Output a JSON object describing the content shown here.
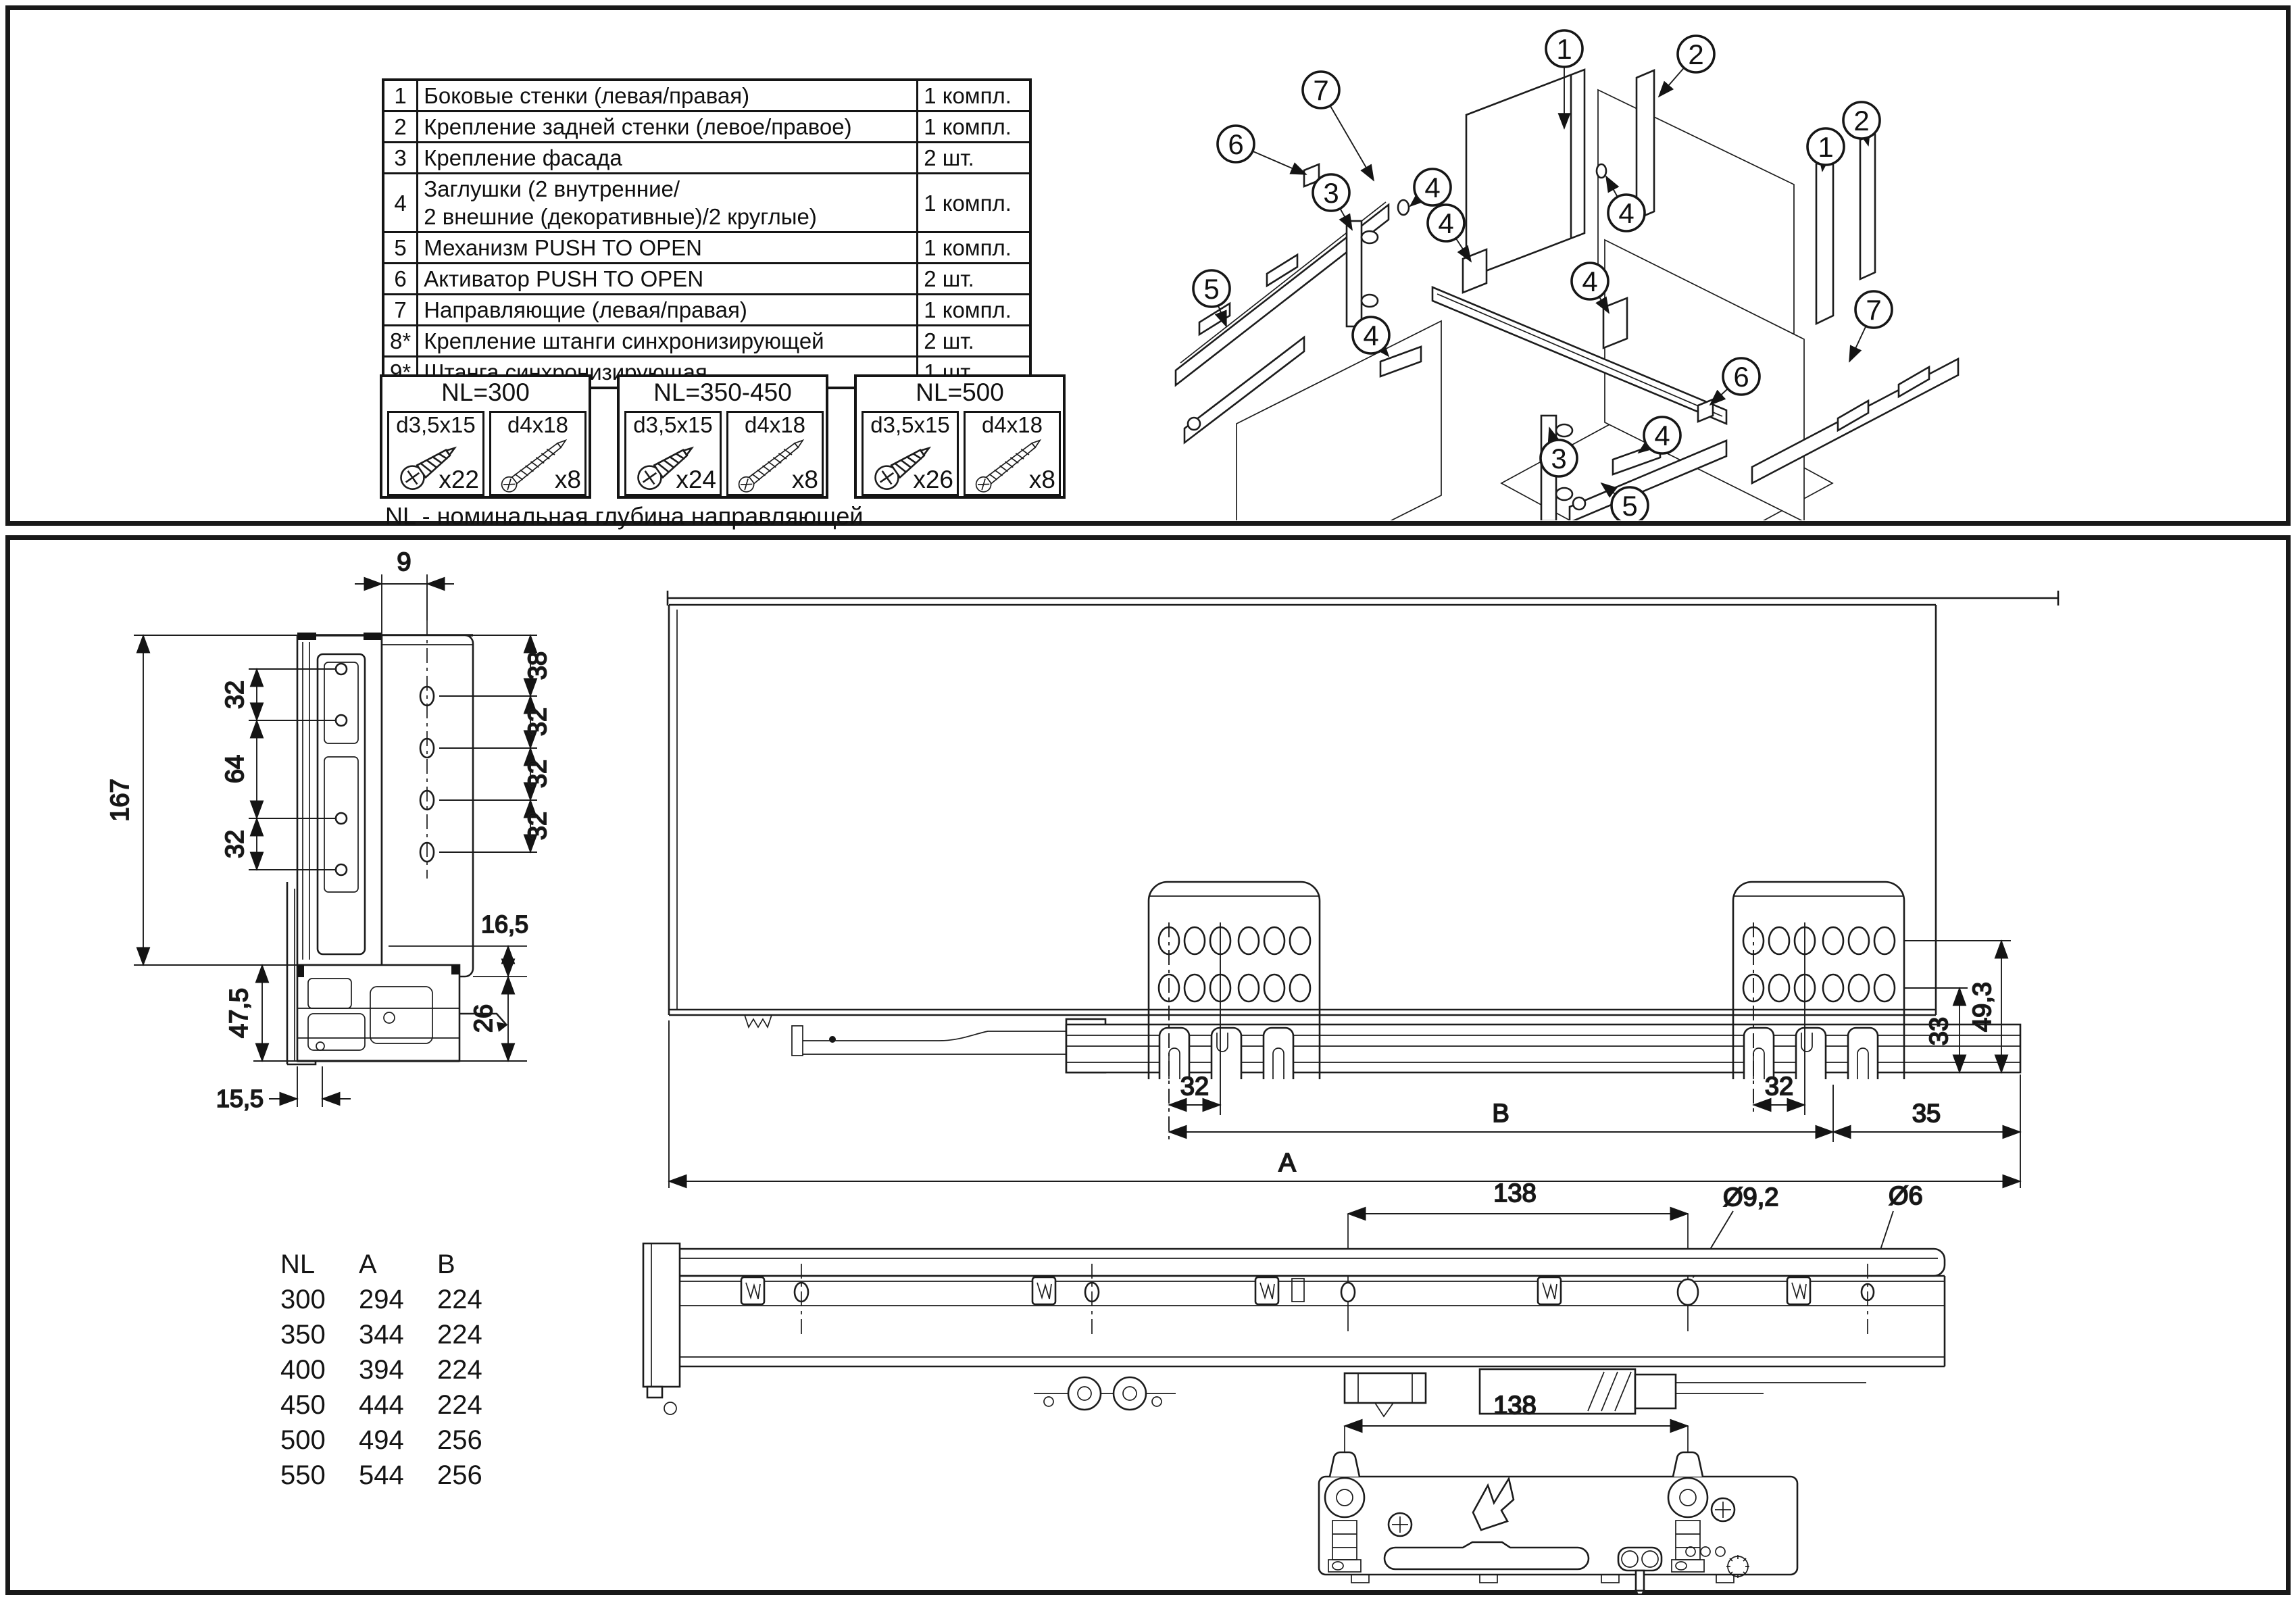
{
  "header": {
    "bullets": [
      "- полное выдвижение",
      "- максимальная нагрузка 40 кг"
    ]
  },
  "parts_table": {
    "rows": [
      {
        "num": "1",
        "name": "Боковые стенки (левая/правая)",
        "qty": "1 компл."
      },
      {
        "num": "2",
        "name": "Крепление задней стенки (левое/правое)",
        "qty": "1 компл."
      },
      {
        "num": "3",
        "name": "Крепление фасада",
        "qty": "2 шт."
      },
      {
        "num": "4",
        "name": "Заглушки (2 внутренние/\n2 внешние (декоративные)/2 круглые)",
        "qty": "1 компл."
      },
      {
        "num": "5",
        "name": "Механизм PUSH TO OPEN",
        "qty": "1 компл."
      },
      {
        "num": "6",
        "name": "Активатор PUSH TO OPEN",
        "qty": "2 шт."
      },
      {
        "num": "7",
        "name": "Направляющие (левая/правая)",
        "qty": "1 компл."
      },
      {
        "num": "8*",
        "name": "Крепление штанги синхронизирующей",
        "qty": "2 шт."
      },
      {
        "num": "9*",
        "name": "Штанга синхронизирующая",
        "qty": "1 шт."
      }
    ]
  },
  "screw_sets": [
    {
      "title": "NL=300",
      "screws": [
        {
          "size": "d3,5x15",
          "count": "x22"
        },
        {
          "size": "d4x18",
          "count": "x8"
        }
      ]
    },
    {
      "title": "NL=350-450",
      "screws": [
        {
          "size": "d3,5x15",
          "count": "x24"
        },
        {
          "size": "d4x18",
          "count": "x8"
        }
      ]
    },
    {
      "title": "NL=500",
      "screws": [
        {
          "size": "d3,5x15",
          "count": "x26"
        },
        {
          "size": "d4x18",
          "count": "x8"
        }
      ]
    }
  ],
  "note": "NL - номинальная глубина направляющей",
  "exploded": {
    "callouts": [
      "7",
      "1",
      "2",
      "6",
      "3",
      "4",
      "4",
      "1",
      "2",
      "4",
      "5",
      "4",
      "4",
      "7",
      "6",
      "4",
      "3",
      "5"
    ]
  },
  "side_view": {
    "top": "9",
    "total": "167",
    "left": [
      "32",
      "64",
      "32"
    ],
    "right": [
      "38",
      "32",
      "32",
      "32"
    ],
    "offset": "16,5",
    "rail_height": "26",
    "bottom_height": "47,5",
    "bottom_width": "15,5"
  },
  "main_view": {
    "pitch_left": "32",
    "pitch_right": "32",
    "len_b": "B",
    "end": "35",
    "len_a": "A",
    "h33": "33",
    "h49": "49,3"
  },
  "rail_view": {
    "spacing": "138",
    "dia_large": "Ø9,2",
    "dia_small": "Ø6"
  },
  "underside_view": {
    "spacing": "138"
  },
  "size_table": {
    "headers": [
      "NL",
      "A",
      "B"
    ],
    "rows": [
      [
        "300",
        "294",
        "224"
      ],
      [
        "350",
        "344",
        "224"
      ],
      [
        "400",
        "394",
        "224"
      ],
      [
        "450",
        "444",
        "224"
      ],
      [
        "500",
        "494",
        "256"
      ],
      [
        "550",
        "544",
        "256"
      ]
    ]
  }
}
